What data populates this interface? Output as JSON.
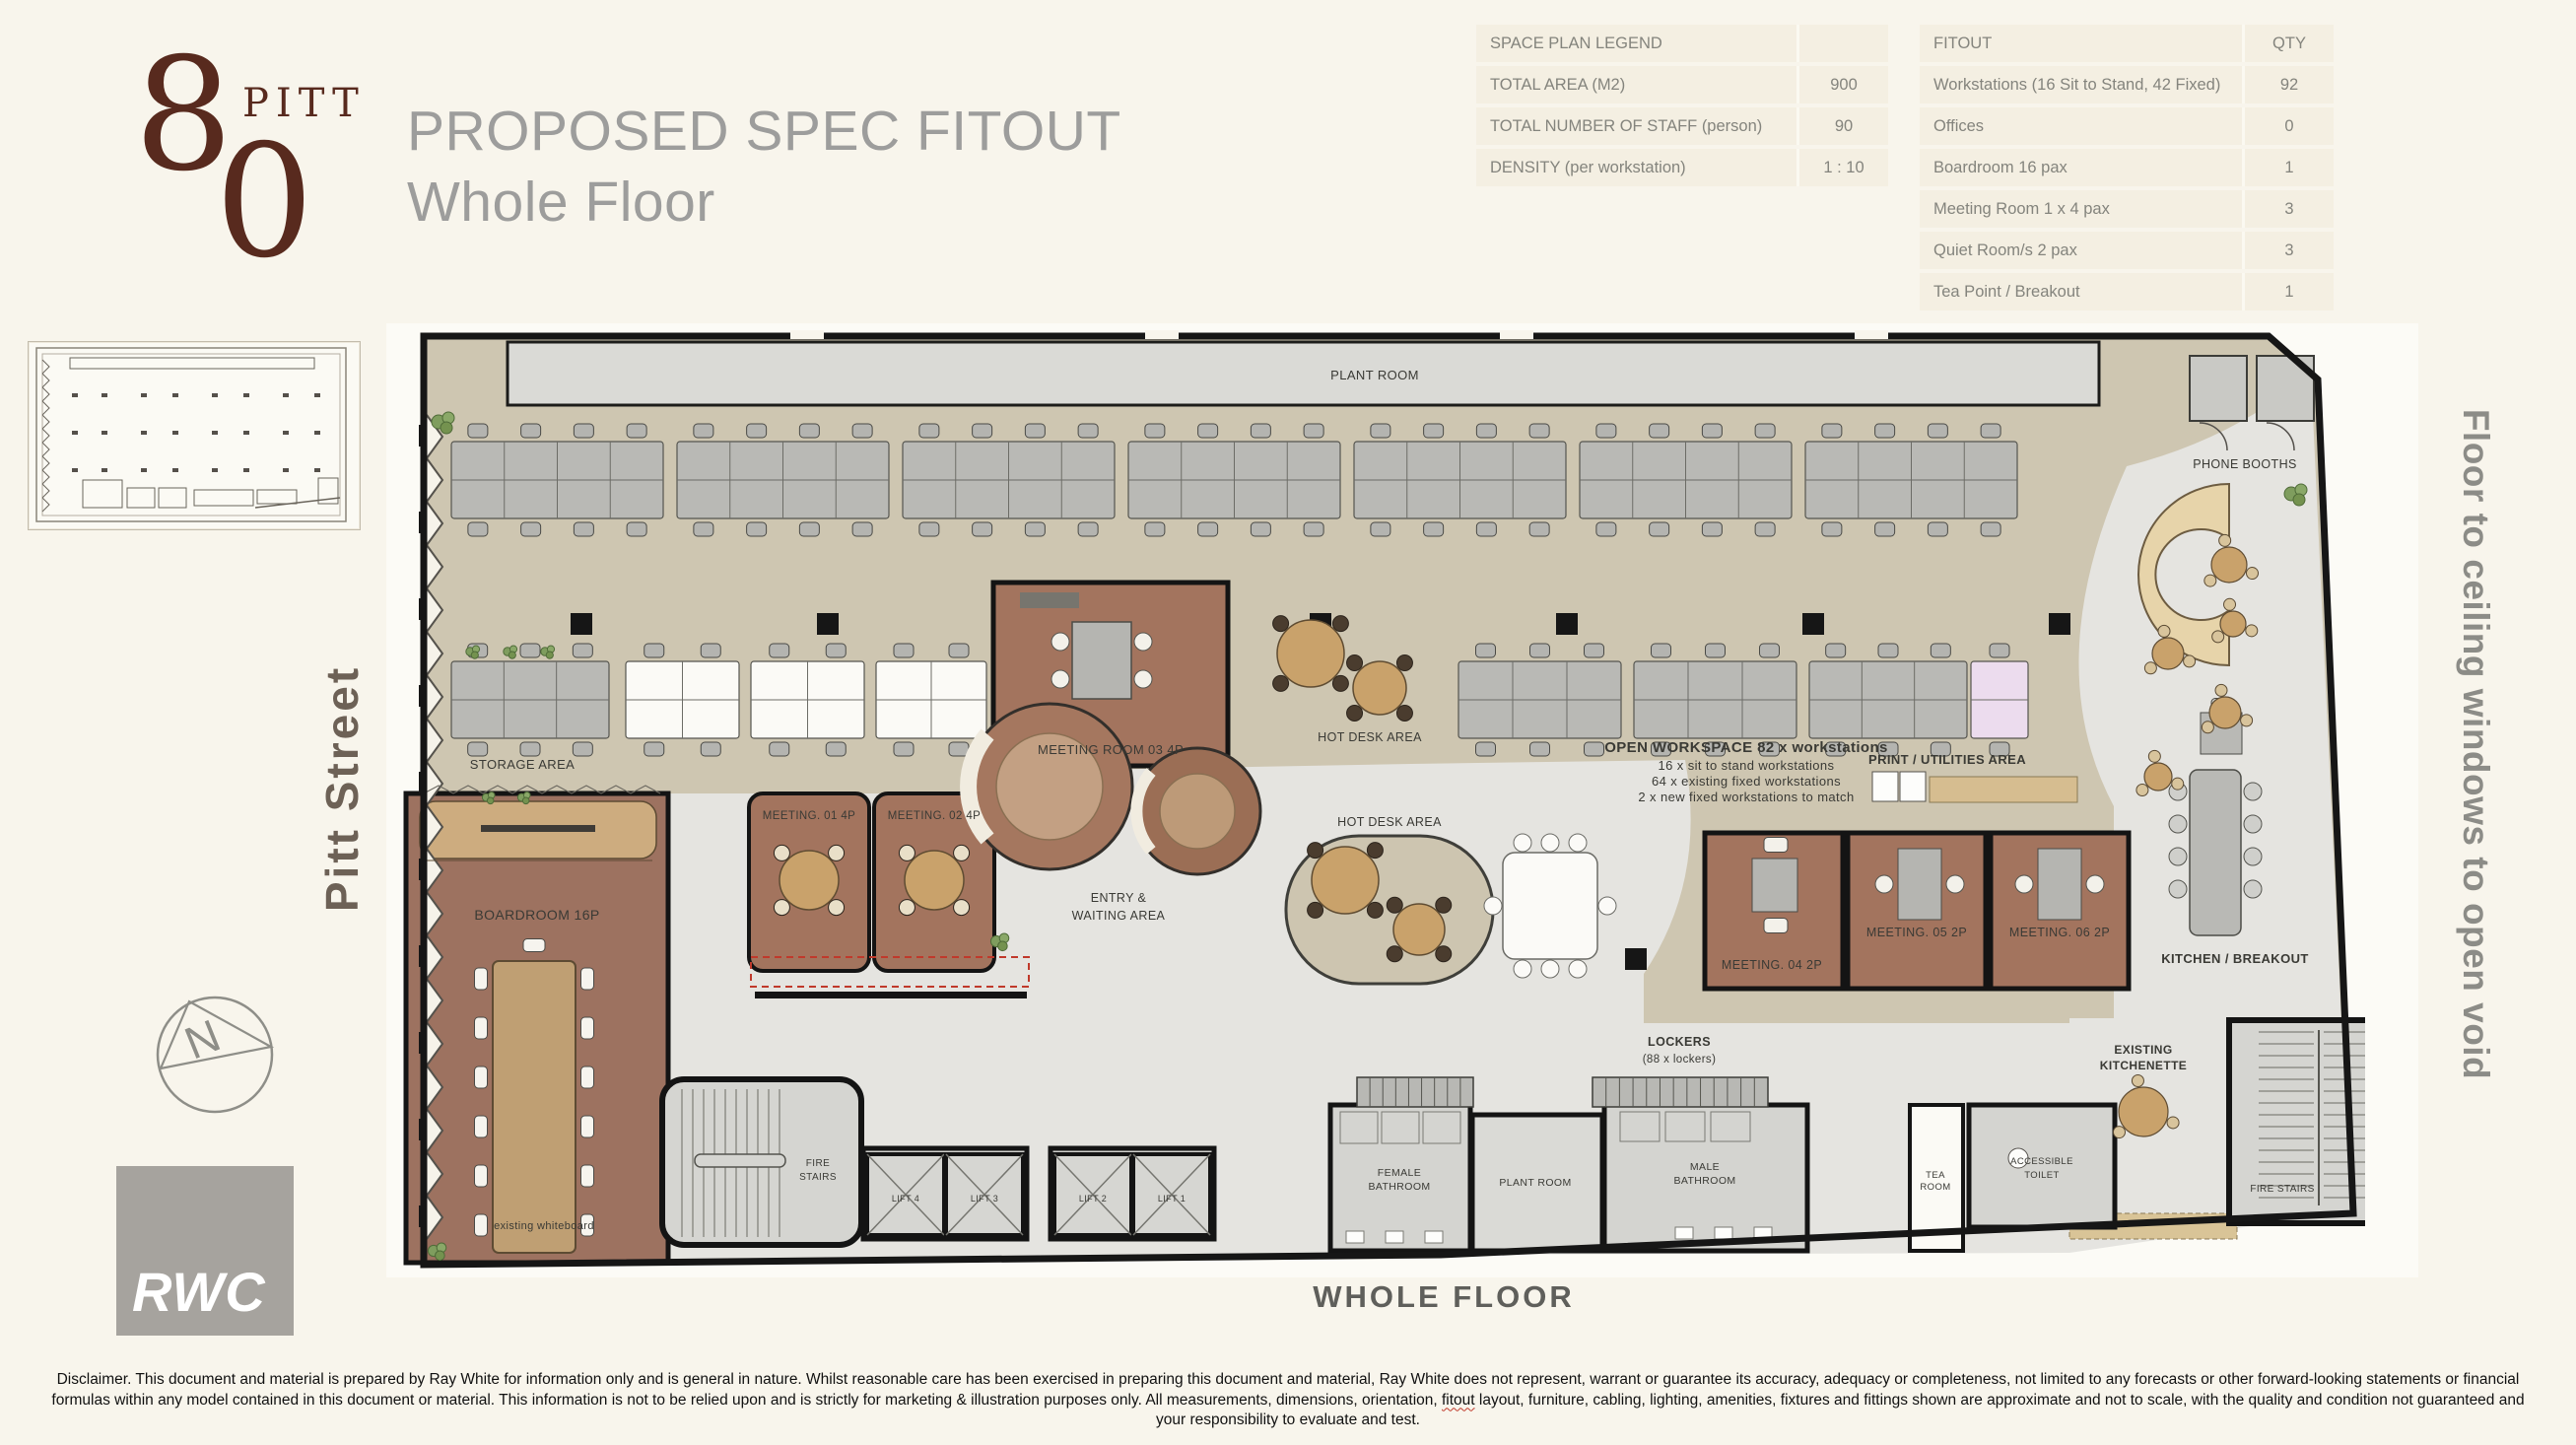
{
  "logo": {
    "digit_top": "8",
    "digit_bottom": "0",
    "word": "PITT"
  },
  "header": {
    "title_line1": "PROPOSED SPEC FITOUT",
    "title_line2": "Whole Floor"
  },
  "legend_table": {
    "header": "SPACE PLAN LEGEND",
    "rows": [
      {
        "label": "TOTAL AREA (M2)",
        "value": "900"
      },
      {
        "label": "TOTAL NUMBER OF STAFF (person)",
        "value": "90"
      },
      {
        "label": "DENSITY (per workstation)",
        "value": "1 : 10"
      }
    ]
  },
  "fitout_table": {
    "header_label": "FITOUT",
    "header_qty": "QTY",
    "rows": [
      {
        "label": "Workstations (16 Sit to Stand, 42 Fixed)",
        "qty": "92"
      },
      {
        "label": "Offices",
        "qty": "0"
      },
      {
        "label": "Boardroom 16 pax",
        "qty": "1"
      },
      {
        "label": "Meeting Room 1 x 4 pax",
        "qty": "3"
      },
      {
        "label": "Quiet Room/s 2 pax",
        "qty": "3"
      },
      {
        "label": "Tea Point / Breakout",
        "qty": "1"
      }
    ]
  },
  "sidebar": {
    "street_label": "Pitt Street",
    "compass_letter": "N",
    "brand": "RWC"
  },
  "right_label": "Floor to ceiling windows to open void",
  "caption": "WHOLE FLOOR",
  "plan": {
    "labels": {
      "plant_room_top": "PLANT ROOM",
      "phone_booths": "PHONE BOOTHS",
      "storage_area": "STORAGE AREA",
      "boardroom": "BOARDROOM 16P",
      "existing_whiteboard": "existing whiteboard",
      "meeting_01": "MEETING. 01 4P",
      "meeting_02": "MEETING. 02 4P",
      "meeting_room_03": "MEETING ROOM 03 4P",
      "hot_desk_area_1": "HOT DESK AREA",
      "hot_desk_area_2": "HOT DESK AREA",
      "open_ws_1": "OPEN WORKSPACE 82 x workstations",
      "open_ws_2": "16 x sit to stand workstations",
      "open_ws_3": "64 x existing fixed workstations",
      "open_ws_4": "2 x new fixed workstations to match",
      "print_utilities": "PRINT / UTILITIES AREA",
      "meeting_04": "MEETING. 04 2P",
      "meeting_05": "MEETING. 05 2P",
      "meeting_06": "MEETING. 06 2P",
      "entry_1": "ENTRY &",
      "entry_2": "WAITING AREA",
      "lockers_1": "LOCKERS",
      "lockers_2": "(88 x lockers)",
      "kitchen_breakout": "KITCHEN / BREAKOUT",
      "existing_kitchenette_1": "EXISTING",
      "existing_kitchenette_2": "KITCHENETTE",
      "fire_stairs_left_1": "FIRE",
      "fire_stairs_left_2": "STAIRS",
      "fire_stairs_right": "FIRE STAIRS",
      "lift_4": "LIFT 4",
      "lift_3": "LIFT 3",
      "lift_2": "LIFT 2",
      "lift_1": "LIFT 1",
      "female_bath_1": "FEMALE",
      "female_bath_2": "BATHROOM",
      "plant_room_bottom": "PLANT ROOM",
      "male_bath_1": "MALE",
      "male_bath_2": "BATHROOM",
      "tea_room_1": "TEA",
      "tea_room_2": "ROOM",
      "accessible_1": "ACCESSIBLE",
      "accessible_2": "TOILET"
    }
  },
  "disclaimer": {
    "part1": "Disclaimer. This document and material is prepared by Ray White for information only and is general in nature.  Whilst reasonable care has been exercised in preparing this document and material,  Ray White does not represent, warrant or guarantee its accuracy, adequacy or completeness, not limited to any forecasts or other forward-looking statements or financial formulas within any model contained in this document or material. This information is not to be relied upon and is strictly for marketing & illustration purposes only. All measurements, dimensions, orientation, ",
    "fitout_word": "fitout",
    "part2": " layout, furniture, cabling, lighting, amenities, fixtures and fittings shown are approximate and not to scale, with the quality and condition not guaranteed and your responsibility to evaluate and test."
  },
  "colors": {
    "background": "#f8f5ec",
    "logo_maroon": "#582a1e",
    "title_gray": "#9d9d9c",
    "carpet_beige": "#cec6b1",
    "terrazzo_gray": "#e5e4e0",
    "room_brown": "#a3745e",
    "wall_black": "#161616",
    "wood_tan": "#cdac7f",
    "table_row": "#f4efe2"
  }
}
